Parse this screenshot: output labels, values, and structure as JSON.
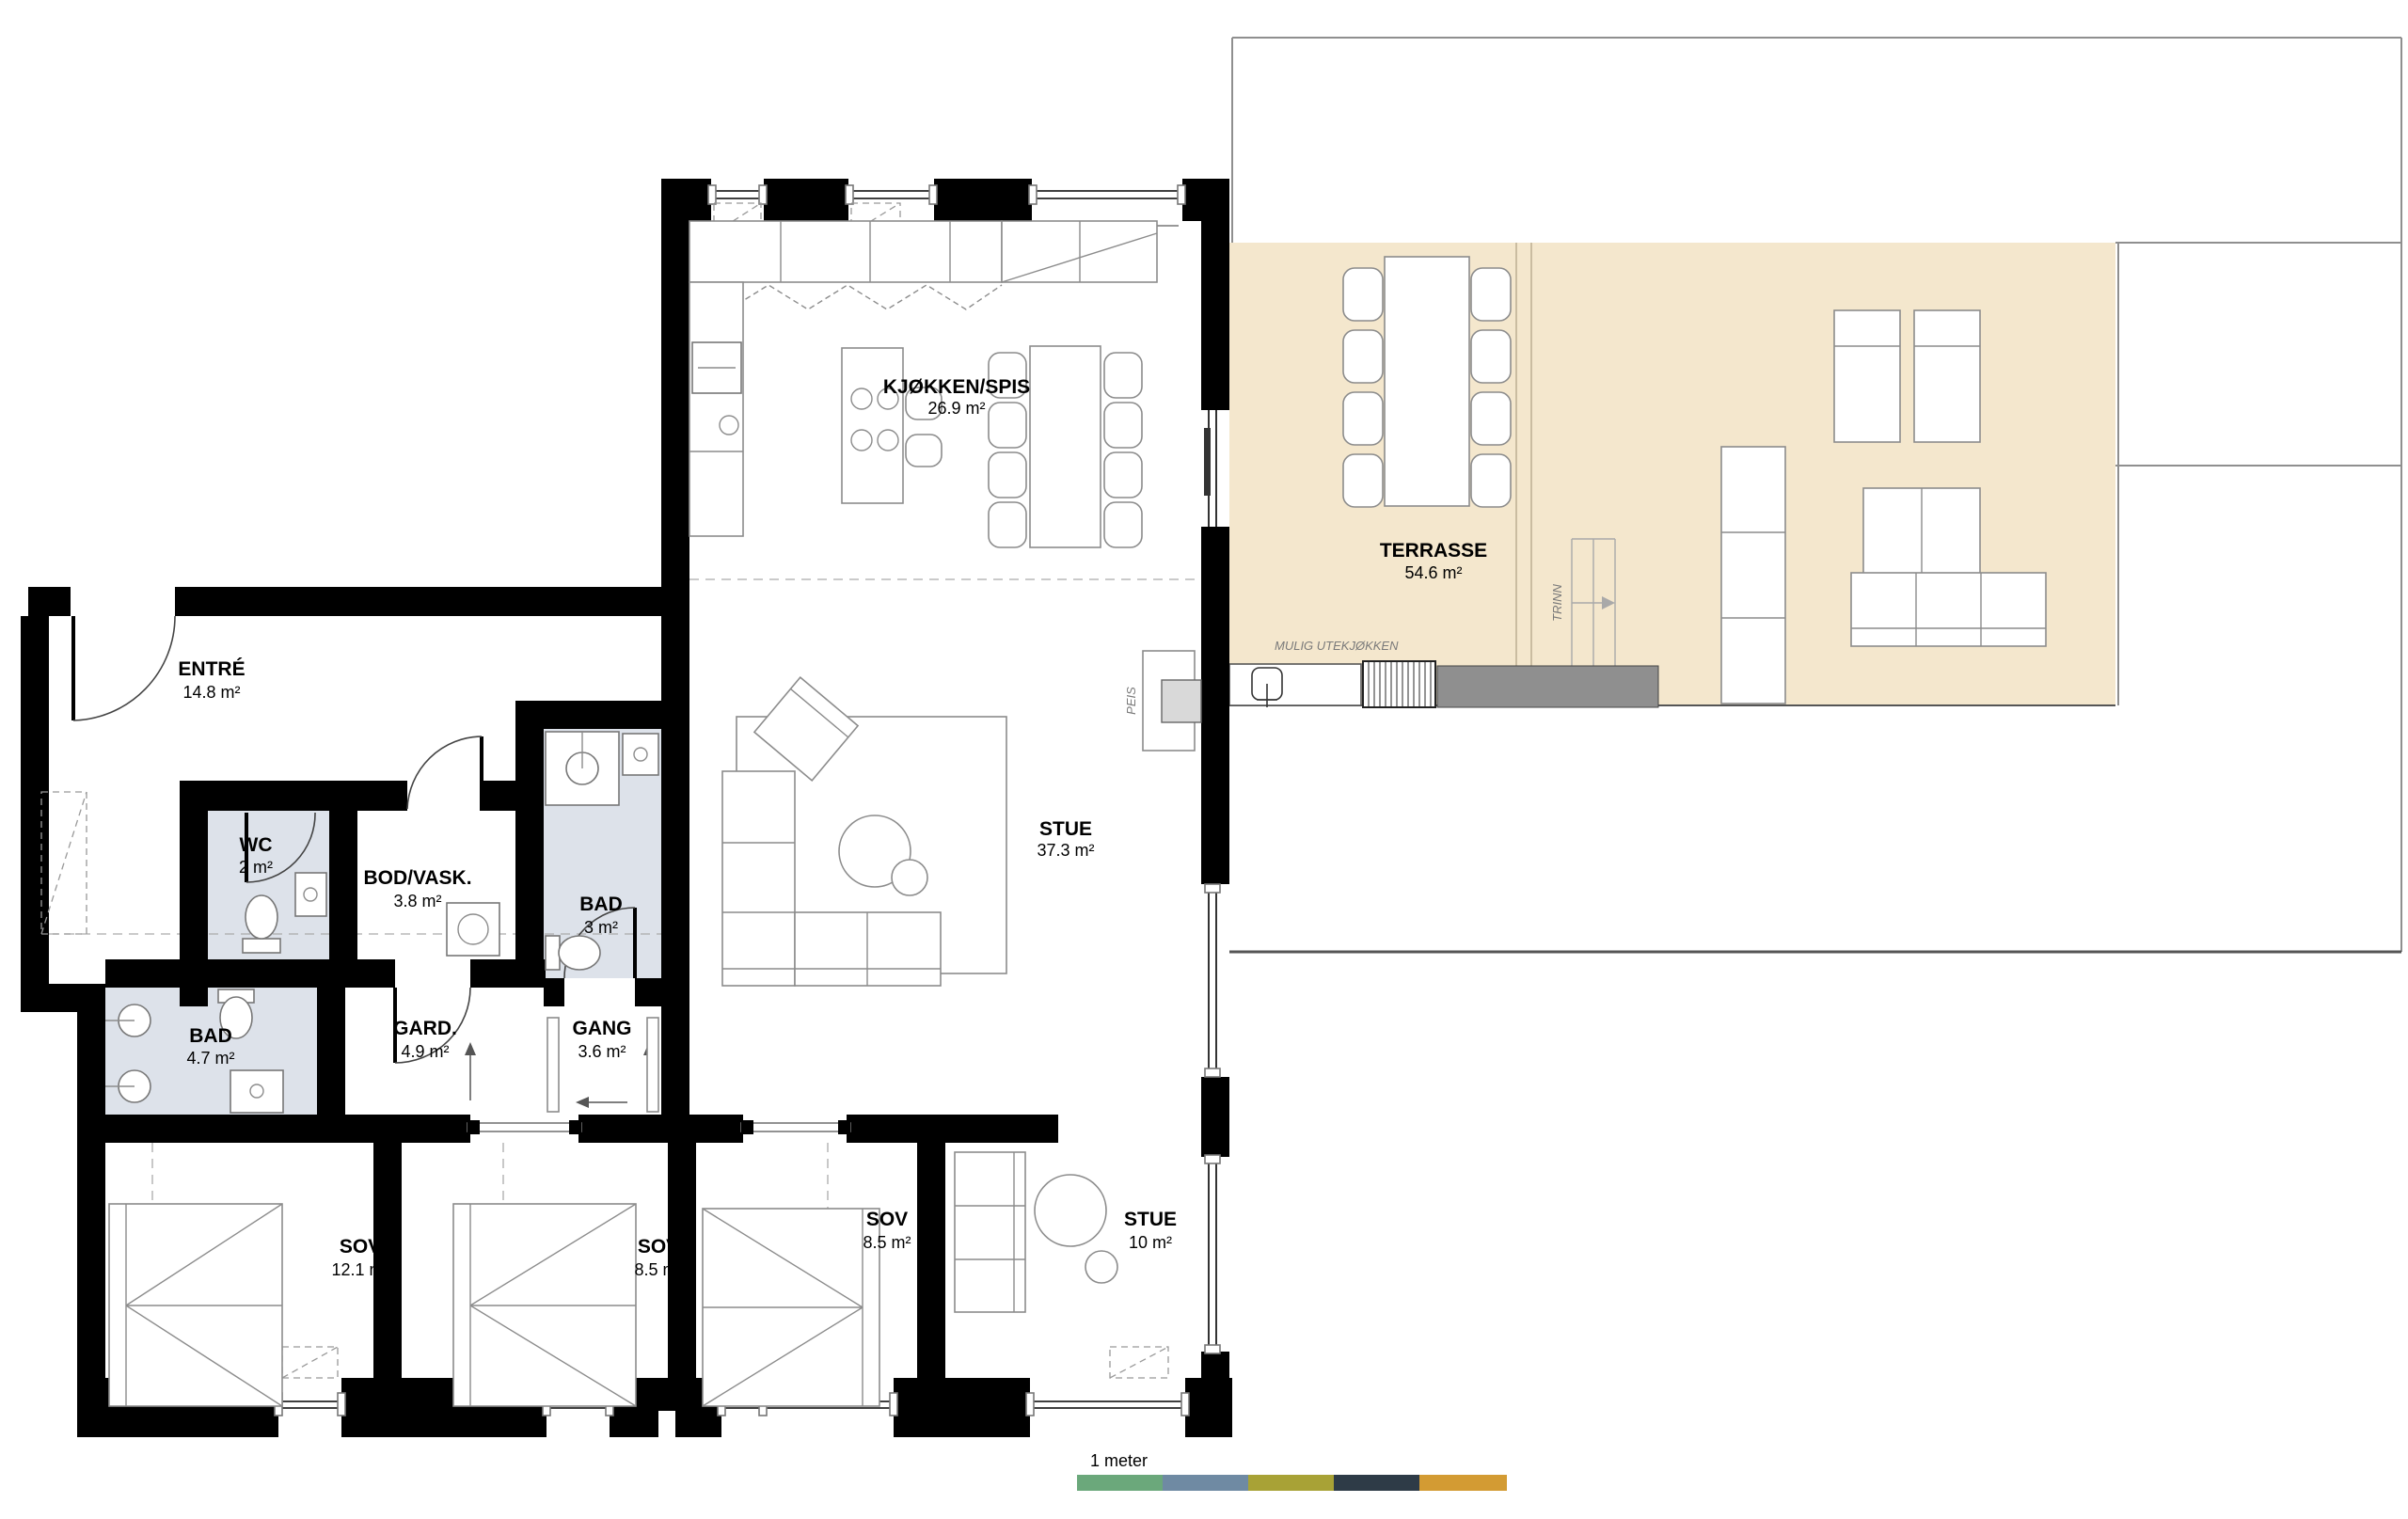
{
  "rooms": [
    {
      "name": "ENTRÉ",
      "area": "14.8 m²"
    },
    {
      "name": "WC",
      "area": "2 m²"
    },
    {
      "name": "BOD/VASK.",
      "area": "3.8 m²"
    },
    {
      "name": "BAD",
      "area": "3 m²"
    },
    {
      "name": "BAD",
      "area": "4.7 m²"
    },
    {
      "name": "GARD.",
      "area": "4.9 m²"
    },
    {
      "name": "GANG",
      "area": "3.6 m²"
    },
    {
      "name": "KJØKKEN/SPIS",
      "area": "26.9 m²"
    },
    {
      "name": "STUE",
      "area": "37.3 m²"
    },
    {
      "name": "SOV",
      "area": "12.1 m²"
    },
    {
      "name": "SOV",
      "area": "8.5 m²"
    },
    {
      "name": "SOV",
      "area": "8.5 m²"
    },
    {
      "name": "STUE",
      "area": "10 m²"
    },
    {
      "name": "TERRASSE",
      "area": "54.6 m²"
    }
  ],
  "annotations": {
    "possible_outdoor_kitchen": "MULIG UTEKJØKKEN",
    "steps": "TRINN",
    "fireplace": "PEIS"
  },
  "scale_bar": {
    "label": "1 meter",
    "colors": [
      "#6ba87b",
      "#6f8aa3",
      "#a8a236",
      "#2e3b47",
      "#d39b33"
    ]
  },
  "colors": {
    "wall": "#000000",
    "wet_room_fill": "#dde2ea",
    "terrace_fill": "#f4e7cd",
    "deck_fill": "#8f8f8f",
    "outline": "#8f8f8f"
  }
}
